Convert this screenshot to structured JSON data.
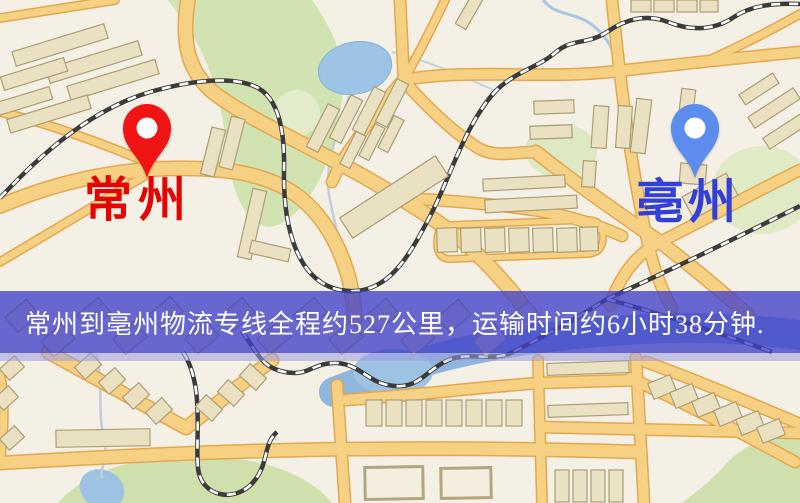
{
  "map": {
    "type": "road-map",
    "features": [
      "roads",
      "railways",
      "buildings",
      "parks",
      "lakes",
      "river"
    ]
  },
  "origin": {
    "label": "常州",
    "pin_color": "#f01414",
    "label_color": "#e60303"
  },
  "destination": {
    "label": "亳州",
    "pin_color": "#5b8cee",
    "label_color": "#3340d8"
  },
  "banner": {
    "text": "常州到亳州物流专线全程约527公里，运输时间约6小时38分钟.",
    "overlay_color": "#4040c8",
    "overlay_opacity": "0.78",
    "text_color": "#ffffff"
  },
  "route_info": {
    "origin_city": "常州",
    "destination_city": "亳州",
    "service": "物流专线",
    "distance_km": "527",
    "duration_hours": "6",
    "duration_minutes": "38"
  },
  "map_colors": {
    "background": "#f4f0e6",
    "road_fill": "#f7d183",
    "road_casing": "#e2a850",
    "water": "#9cc4e6",
    "park": "#d2e3b2",
    "building": "#eae1c2",
    "railway": "#3b3b3b"
  }
}
